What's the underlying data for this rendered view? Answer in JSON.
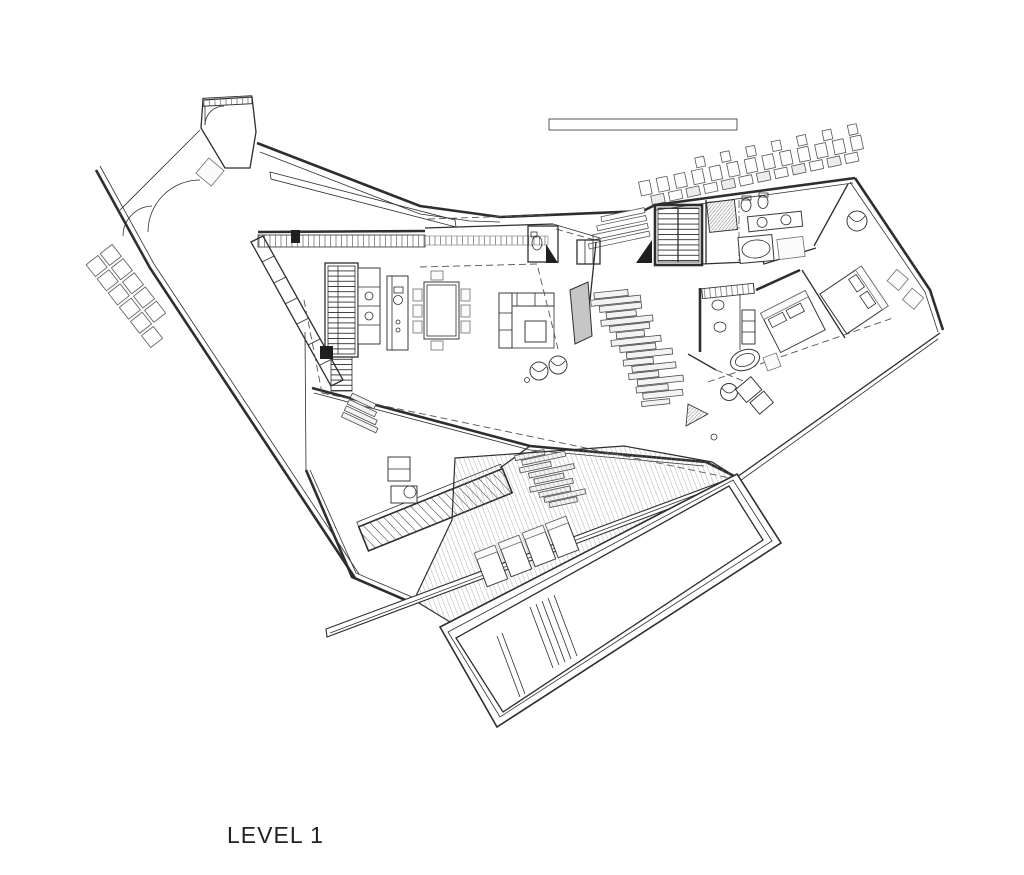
{
  "drawing": {
    "title": "LEVEL 1",
    "type": "architectural floor plan",
    "paper_color": "#ffffff",
    "ink_color": "#2e2e2e",
    "hatch_color": "#8f8f8f"
  }
}
